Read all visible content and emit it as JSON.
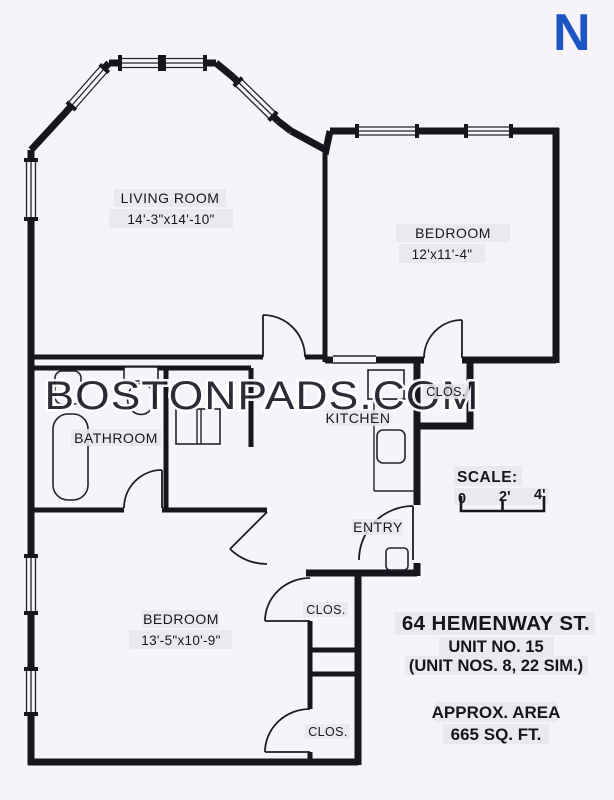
{
  "north_indicator": "N",
  "watermark": "BOSTONPADS.COM",
  "rooms": {
    "living_room": {
      "name": "LIVING ROOM",
      "dims": "14'-3\"x14'-10\""
    },
    "bedroom1": {
      "name": "BEDROOM",
      "dims": "12'x11'-4\""
    },
    "bedroom2": {
      "name": "BEDROOM",
      "dims": "13'-5\"x10'-9\""
    },
    "bathroom": {
      "name": "BATHROOM"
    },
    "kitchen": {
      "name": "KITCHEN"
    },
    "entry": {
      "name": "ENTRY"
    },
    "closet_bedroom1": {
      "name": "CLOS."
    },
    "closet_bedroom2_upper": {
      "name": "CLOS."
    },
    "closet_bedroom2_lower": {
      "name": "CLOS."
    }
  },
  "scale": {
    "label": "SCALE:",
    "tick0": "0",
    "tick2": "2'",
    "tick4": "4'"
  },
  "address": {
    "street": "64 HEMENWAY ST.",
    "unit": "UNIT NO. 15",
    "similar": "(UNIT NOS. 8, 22 SIM.)",
    "area_label": "APPROX. AREA",
    "area_value": "665 SQ. FT."
  },
  "colors": {
    "wall": "#16161f",
    "north_blue": "#1e55c5",
    "background": "#f6f4f9",
    "label_tape": "#e9e6ef"
  }
}
